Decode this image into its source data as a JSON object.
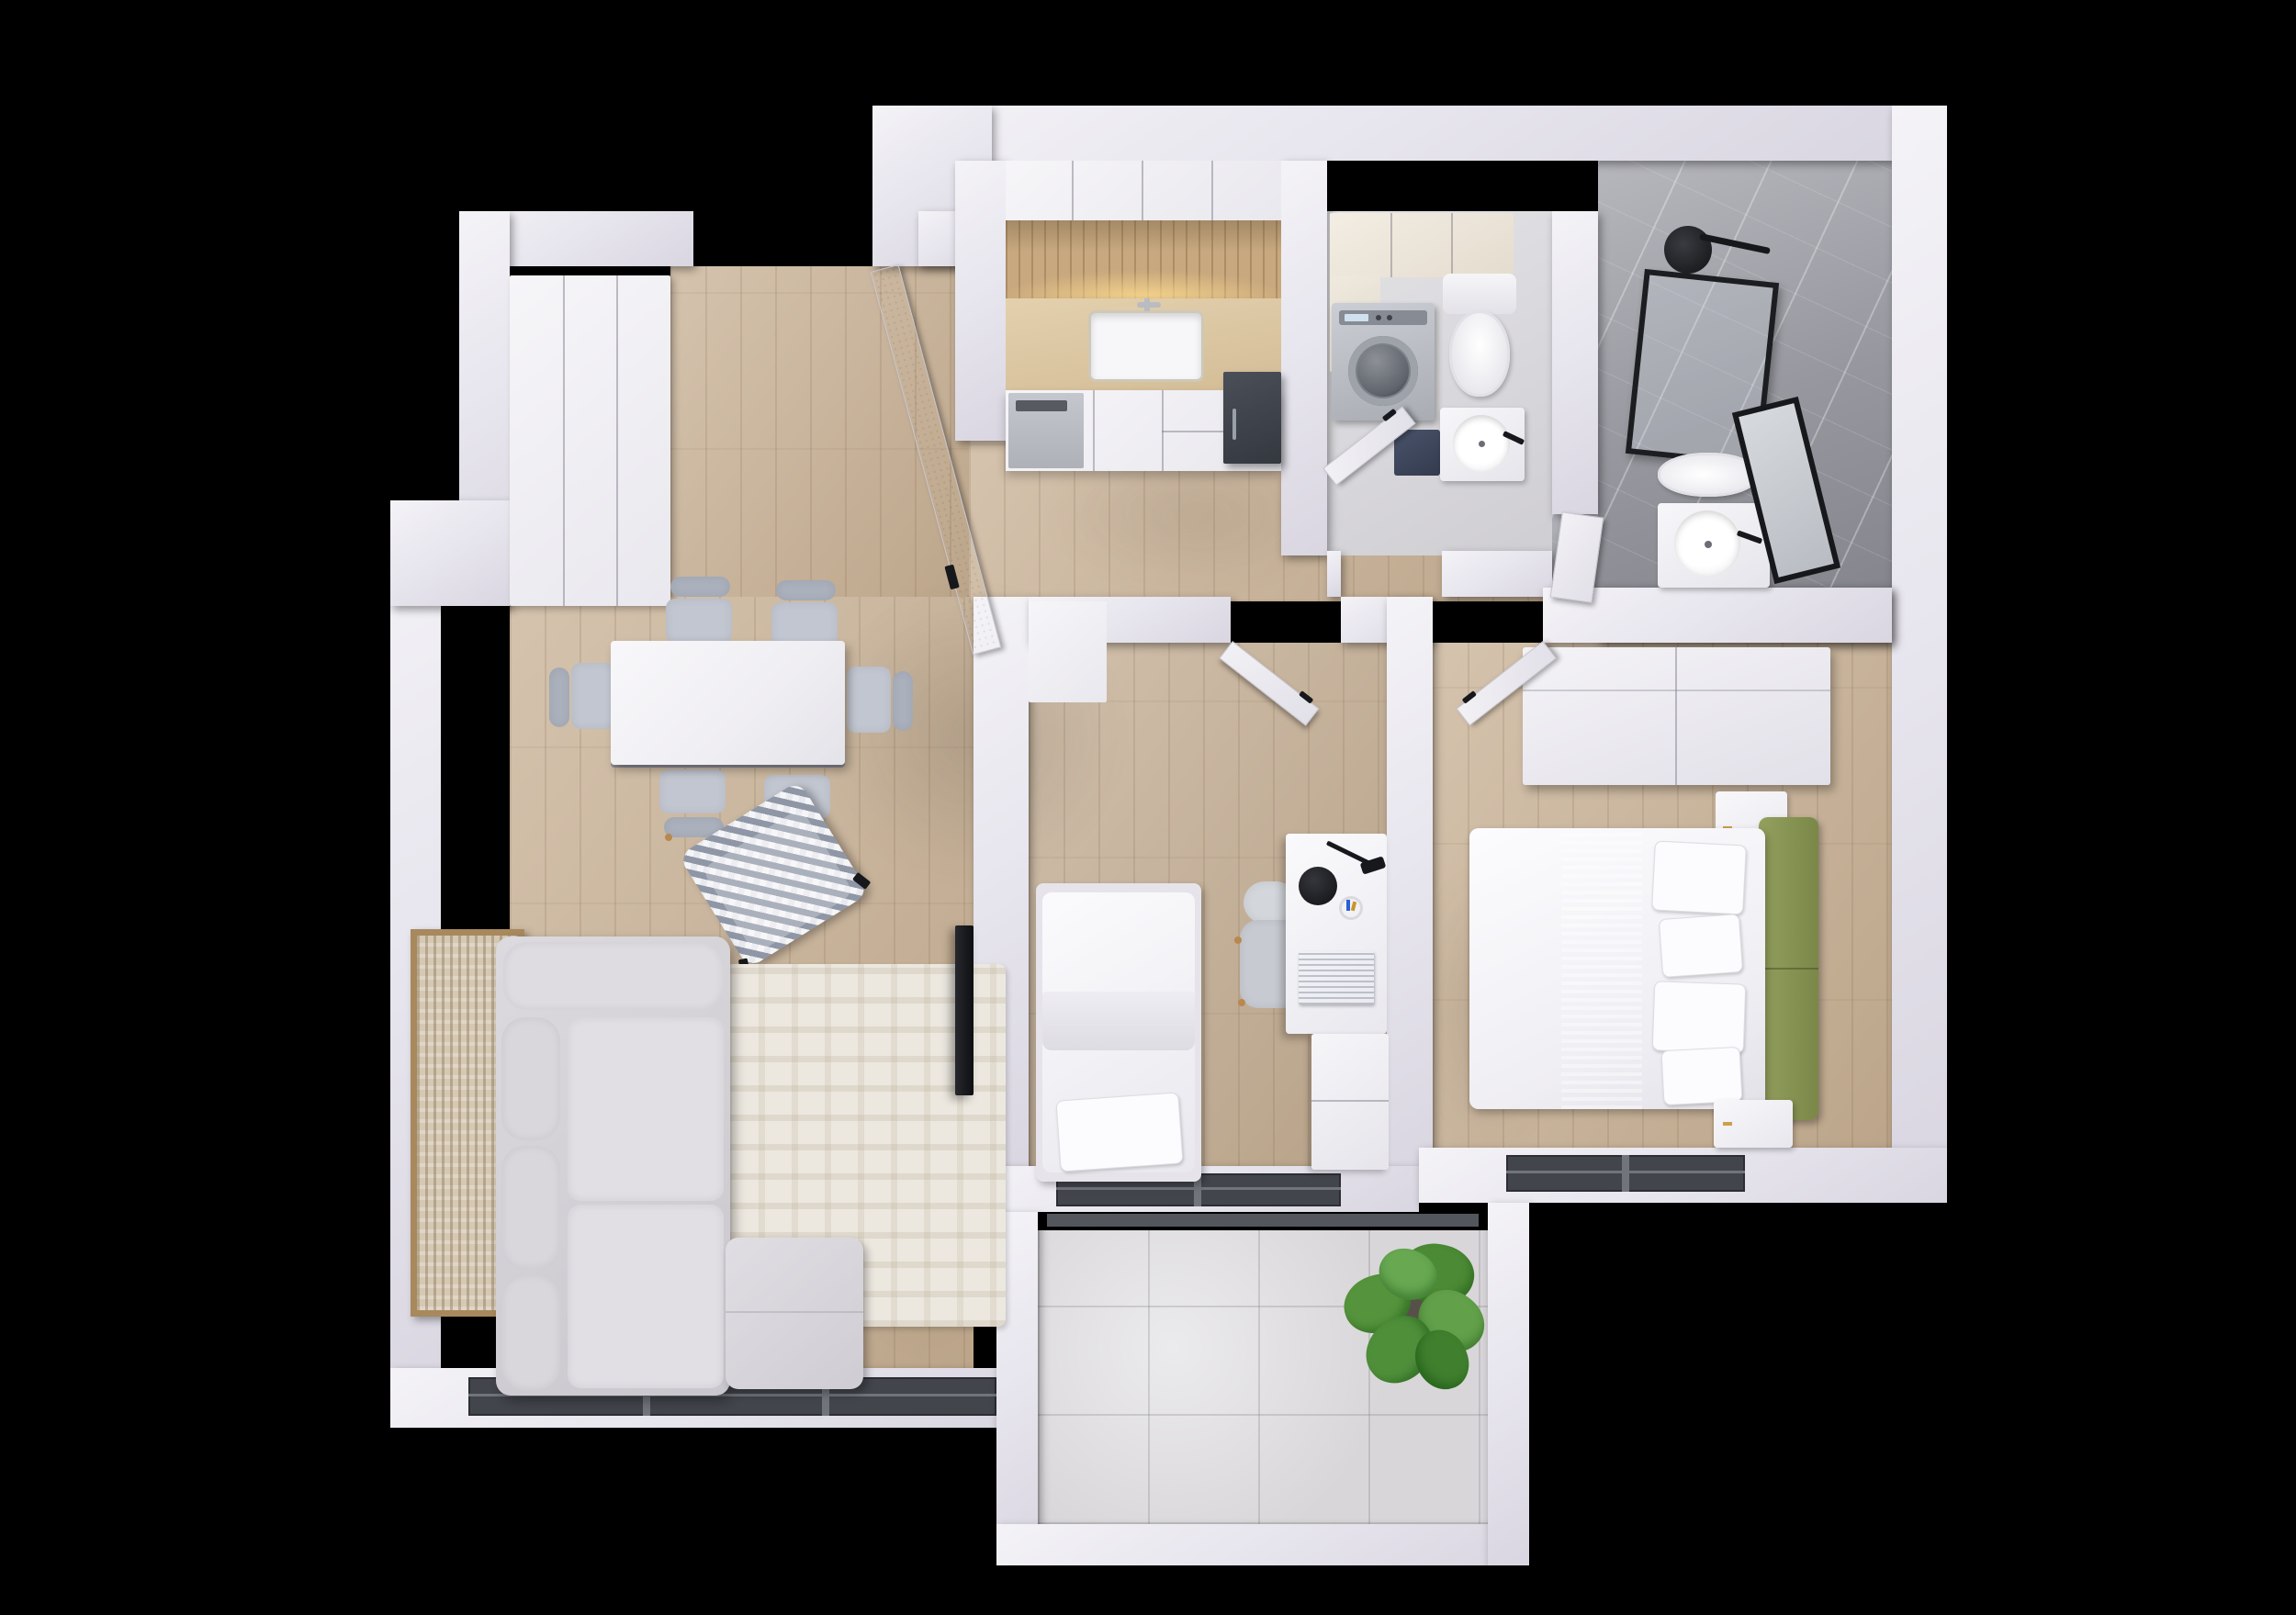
{
  "scene": {
    "kind": "3d-floor-plan-render",
    "view": "top-down",
    "background": "#000000",
    "description": "two-bedroom-apartment-with-balcony"
  },
  "palette": {
    "wall": "#e8e6ee",
    "wood_floor": "#c9b296",
    "marble": "#9b9ca3",
    "balcony_tile": "#d8d6d9",
    "laundry_floor": "#d9d8dc",
    "window_frame": "#42454c",
    "sofa_gray": "#d6d4d8",
    "chair_gray": "#c2c6d0",
    "headboard_green": "#8a9356",
    "plant_green": "#55943c",
    "accent_black": "#17181b",
    "steel": "#b7bac0",
    "navy_cabinet": "#3d4555",
    "art_frame": "#a8895e",
    "backsplash_glow": "#f4d9a0"
  },
  "rooms": {
    "living": {
      "label": "living-room",
      "furniture": [
        "corner-sofa",
        "area-rug",
        "tv",
        "wall-art",
        "panorama-window"
      ]
    },
    "dining": {
      "label": "dining-area",
      "furniture": [
        "dining-table",
        "dining-chairs-x6",
        "houndstooth-armchair"
      ]
    },
    "entry": {
      "label": "entry-hall",
      "furniture": [
        "front-door",
        "wardrobe"
      ]
    },
    "kitchen": {
      "label": "kitchen",
      "furniture": [
        "upper-cabinets",
        "wood-backsplash",
        "sink",
        "dishwasher",
        "tall-unit"
      ]
    },
    "laundry": {
      "label": "laundry-wc",
      "furniture": [
        "washing-machine",
        "toilet",
        "round-basin",
        "cabinets",
        "door"
      ]
    },
    "bath": {
      "label": "bathroom",
      "furniture": [
        "walk-in-shower",
        "shower-head",
        "toilet",
        "round-basin",
        "mirror",
        "door"
      ]
    },
    "kids": {
      "label": "small-bedroom",
      "furniture": [
        "single-bed",
        "desk",
        "desk-chair",
        "desk-lamp",
        "drawer-unit",
        "window",
        "door"
      ]
    },
    "bedroom": {
      "label": "main-bedroom",
      "furniture": [
        "double-bed",
        "green-headboard",
        "nightstand-north",
        "nightstand-south",
        "sliding-wardrobe",
        "window",
        "door"
      ]
    },
    "balcony": {
      "label": "balcony",
      "furniture": [
        "potted-plant"
      ]
    }
  }
}
